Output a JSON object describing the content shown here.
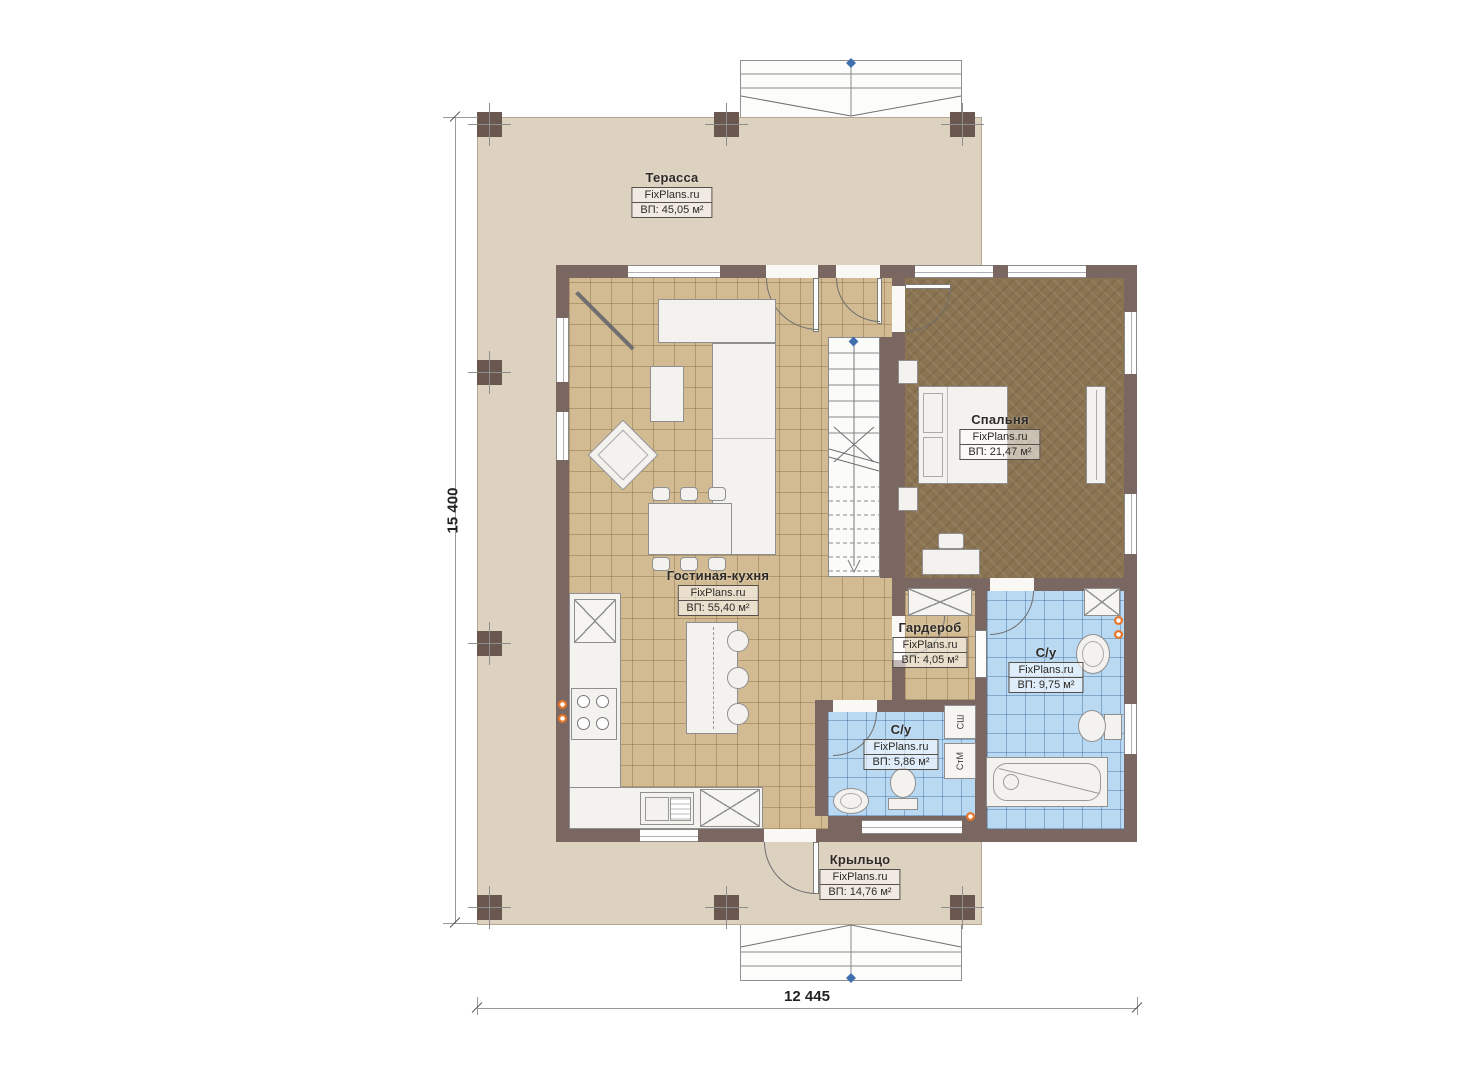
{
  "plan": {
    "brand": "FixPlans.ru",
    "dimensions": {
      "vertical": "15 400",
      "horizontal": "12 445"
    },
    "rooms": [
      {
        "key": "terrace",
        "name": "Терасса",
        "brand": "FixPlans.ru",
        "area": "ВП: 45,05 м²"
      },
      {
        "key": "living-kitchen",
        "name": "Гостиная-кухня",
        "brand": "FixPlans.ru",
        "area": "ВП: 55,40 м²"
      },
      {
        "key": "bedroom",
        "name": "Спальня",
        "brand": "FixPlans.ru",
        "area": "ВП: 21,47 м²"
      },
      {
        "key": "wardrobe",
        "name": "Гардероб",
        "brand": "FixPlans.ru",
        "area": "ВП: 4,05 м²"
      },
      {
        "key": "bathroom-main",
        "name": "С/у",
        "brand": "FixPlans.ru",
        "area": "ВП: 9,75 м²"
      },
      {
        "key": "bathroom-small",
        "name": "С/у",
        "brand": "FixPlans.ru",
        "area": "ВП: 5,86 м²"
      },
      {
        "key": "porch",
        "name": "Крыльцо",
        "brand": "FixPlans.ru",
        "area": "ВП: 14,76 м²"
      }
    ],
    "appliances": {
      "dryer_label": "СШ",
      "washer_label": "СтМ"
    },
    "colors": {
      "wall": "#7a6761",
      "terrace_floor": "#ddd1c0",
      "living_floor": "#d2bb92",
      "bedroom_floor": "#8b7452",
      "bath_floor": "#b9d9f3",
      "outlet": "#e8762a",
      "marker": "#3f6fae"
    }
  }
}
